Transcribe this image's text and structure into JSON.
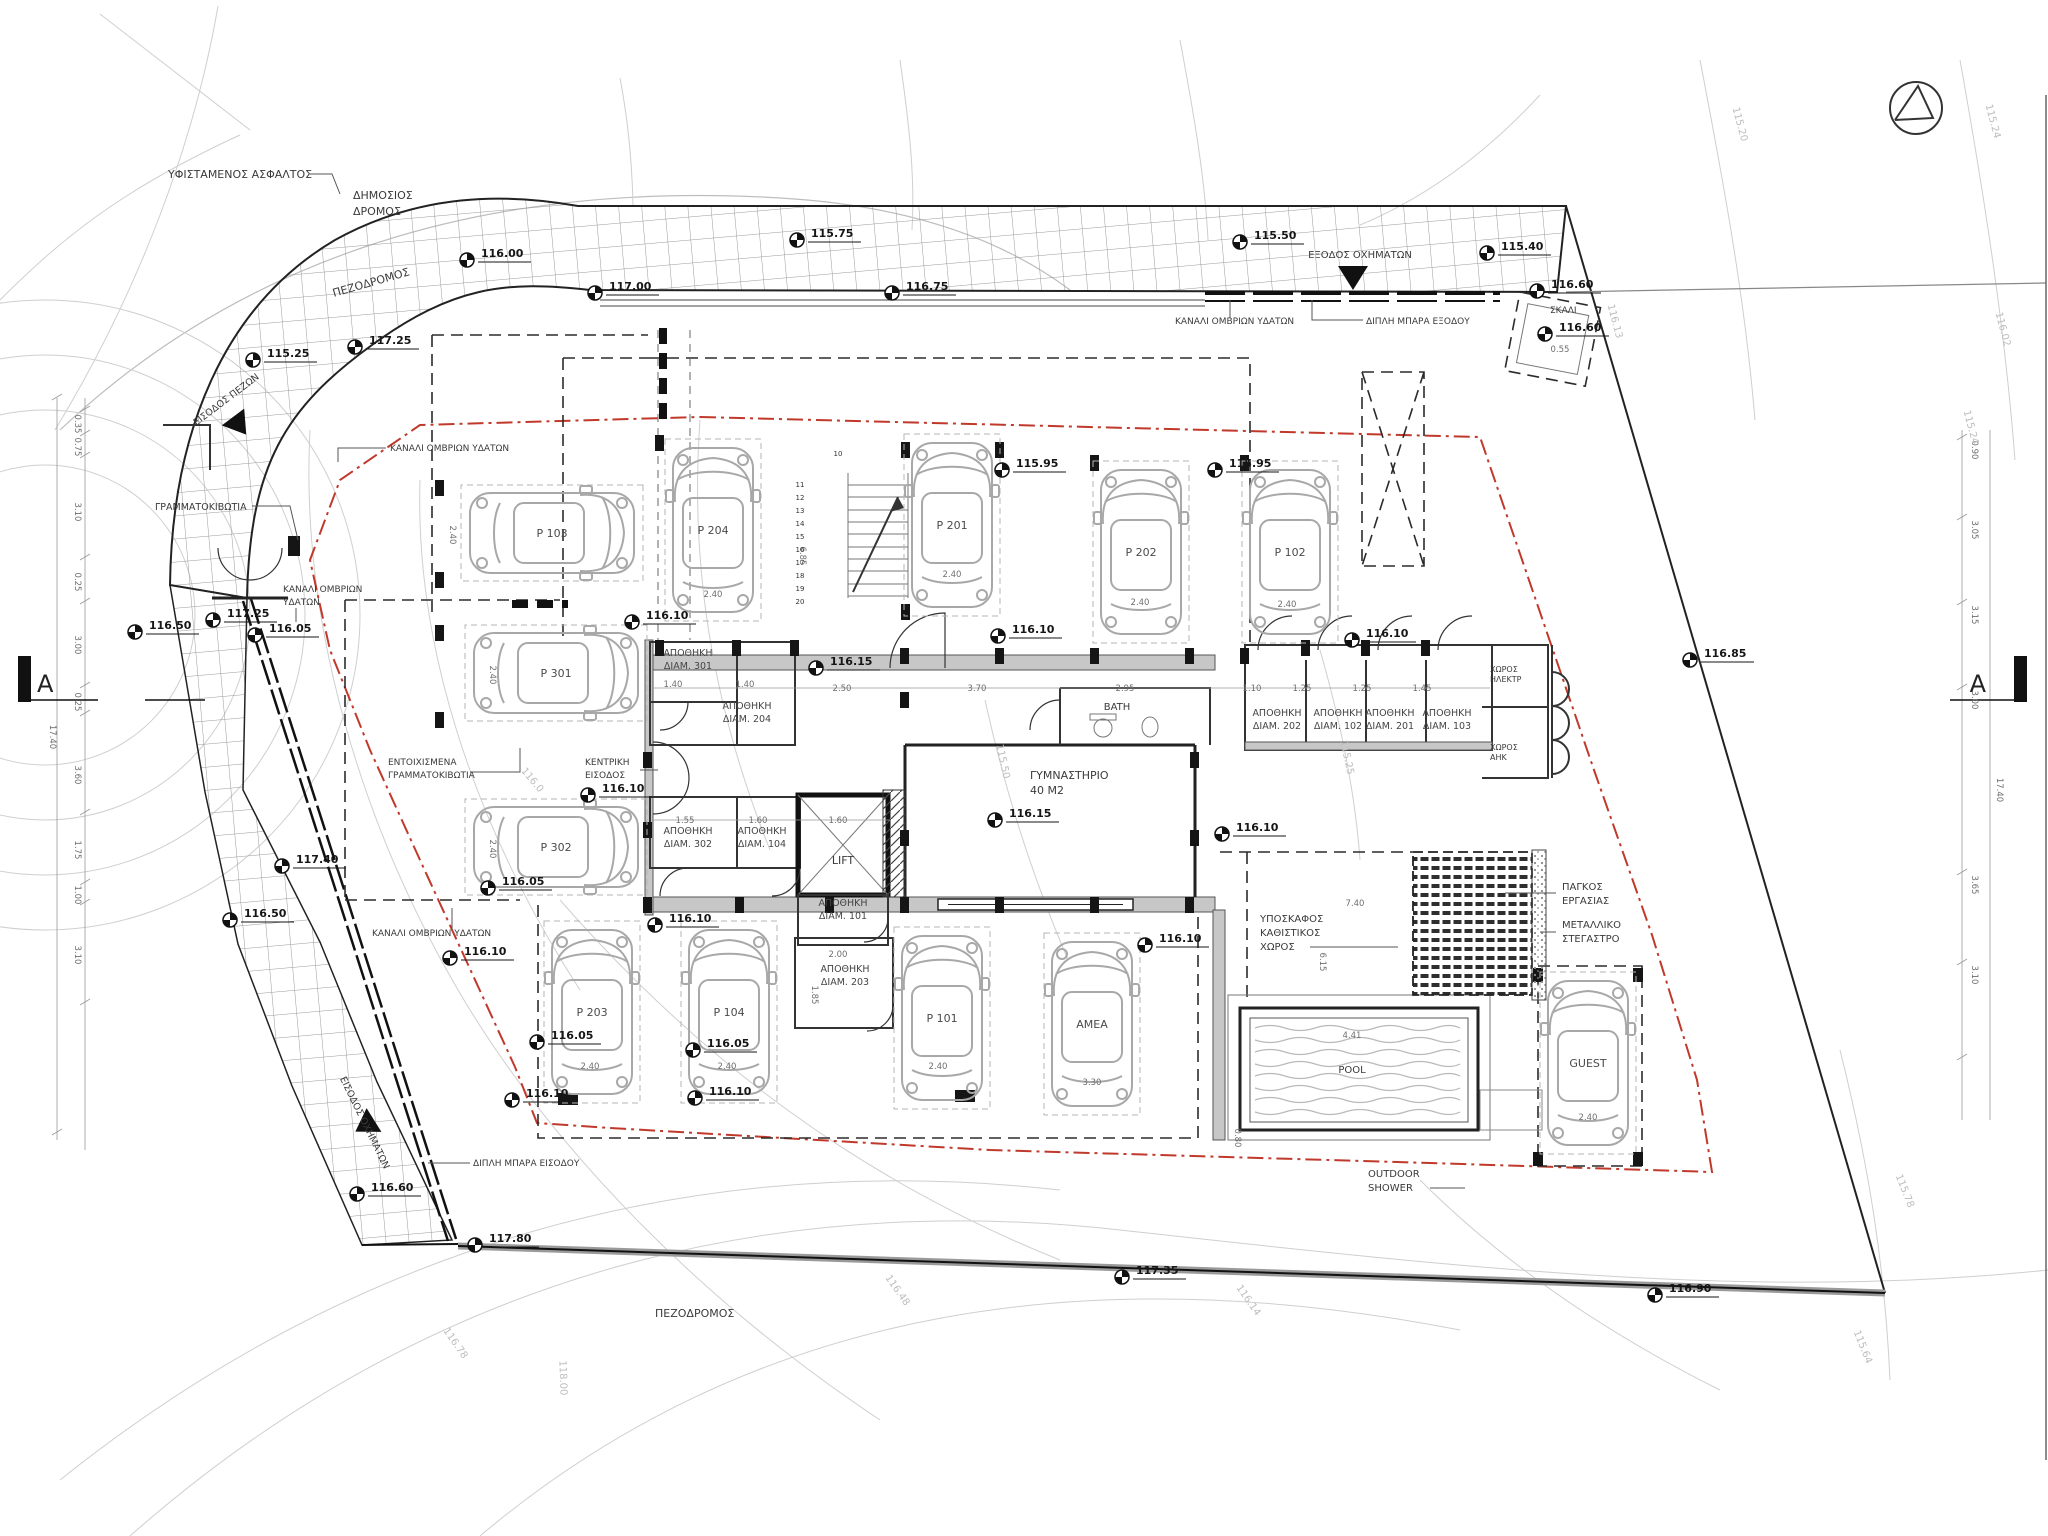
{
  "drawing": {
    "type": "architectural-site-plan",
    "language": "el"
  },
  "colors": {
    "boundary_red": "#c0392b",
    "hatch_gray": "#9a9a9a",
    "contour_gray": "#cfcfcf",
    "wall_dark": "#222222",
    "wall_fill": "#c7c7c7",
    "car_gray": "#a8a8a8"
  },
  "section_marker": {
    "letter": "A"
  },
  "annotations": [
    {
      "text": "ΥΦΙΣΤΑΜΕΝΟΣ ΑΣΦΑΛΤΟΣ",
      "x": 168,
      "y": 178,
      "size": 11
    },
    {
      "text": "ΔΗΜΟΣΙΟΣ",
      "x": 353,
      "y": 199,
      "size": 11
    },
    {
      "text": "ΔΡΟΜΟΣ",
      "x": 353,
      "y": 215,
      "size": 11
    },
    {
      "text": "ΠΕΖΟΔΡΟΜΟΣ",
      "x": 372,
      "y": 286,
      "size": 11,
      "rot": -16,
      "anchor": "middle"
    },
    {
      "text": "ΕΞΟΔΟΣ ΟΧΗΜΑΤΩΝ",
      "x": 1360,
      "y": 258,
      "size": 10,
      "anchor": "middle"
    },
    {
      "text": "ΚΑΝΑΛΙ ΟΜΒΡΙΩΝ ΥΔΑΤΩΝ",
      "x": 1175,
      "y": 324,
      "size": 9
    },
    {
      "text": "ΔΙΠΛΗ ΜΠΑΡΑ ΕΞΟΔΟΥ",
      "x": 1366,
      "y": 324,
      "size": 9
    },
    {
      "text": "ΣΚΑΛΙ",
      "x": 1550,
      "y": 313,
      "size": 9
    },
    {
      "text": "ΕΙΣΟΔΟΣ ΠΕΖΩΝ",
      "x": 228,
      "y": 402,
      "size": 9.5,
      "rot": -37,
      "anchor": "middle"
    },
    {
      "text": "ΓΡΑΜΜΑΤΟΚΙΒΩΤΙΑ",
      "x": 155,
      "y": 510,
      "size": 9.5
    },
    {
      "text": "ΚΑΝΑΛΙ ΟΜΒΡΙΩΝ",
      "x": 283,
      "y": 592,
      "size": 9
    },
    {
      "text": "ΥΔΑΤΩΝ",
      "x": 283,
      "y": 605,
      "size": 9
    },
    {
      "text": "ΚΑΝΑΛΙ ΟΜΒΡΙΩΝ ΥΔΑΤΩΝ",
      "x": 390,
      "y": 451,
      "size": 9
    },
    {
      "text": "ΕΝΤΟΙΧΙΣΜΕΝΑ",
      "x": 388,
      "y": 765,
      "size": 9
    },
    {
      "text": "ΓΡΑΜΜΑΤΟΚΙΒΩΤΙΑ",
      "x": 388,
      "y": 778,
      "size": 9
    },
    {
      "text": "ΚΕΝΤΡΙΚΗ",
      "x": 585,
      "y": 765,
      "size": 9
    },
    {
      "text": "ΕΙΣΟΔΟΣ",
      "x": 585,
      "y": 778,
      "size": 9
    },
    {
      "text": "ΚΑΝΑΛΙ ΟΜΒΡΙΩΝ ΥΔΑΤΩΝ",
      "x": 372,
      "y": 936,
      "size": 9
    },
    {
      "text": "ΕΙΣΟΔΟΣ ΟΧΗΜΑΤΩΝ",
      "x": 362,
      "y": 1124,
      "size": 9.5,
      "rot": 64,
      "anchor": "middle"
    },
    {
      "text": "ΔΙΠΛΗ ΜΠΑΡΑ ΕΙΣΟΔΟΥ",
      "x": 473,
      "y": 1166,
      "size": 9
    },
    {
      "text": "ΠΕΖΟΔΡΟΜΟΣ",
      "x": 655,
      "y": 1317,
      "size": 11
    },
    {
      "text": "ΓΥΜΝΑΣΤΗΡΙΟ",
      "x": 1030,
      "y": 779,
      "size": 11
    },
    {
      "text": "40 M2",
      "x": 1030,
      "y": 794,
      "size": 11
    },
    {
      "text": "BATH",
      "x": 1117,
      "y": 710,
      "size": 10,
      "anchor": "middle"
    },
    {
      "text": "LIFT",
      "x": 843,
      "y": 864,
      "size": 11,
      "anchor": "middle"
    },
    {
      "text": "ΥΠΟΣΚΑΦΟΣ",
      "x": 1260,
      "y": 922,
      "size": 10
    },
    {
      "text": "ΚΑΘΙΣΤΙΚΟΣ",
      "x": 1260,
      "y": 936,
      "size": 10
    },
    {
      "text": "ΧΩΡΟΣ",
      "x": 1260,
      "y": 950,
      "size": 10
    },
    {
      "text": "ΠΑΓΚΟΣ",
      "x": 1562,
      "y": 890,
      "size": 10
    },
    {
      "text": "ΕΡΓΑΣΙΑΣ",
      "x": 1562,
      "y": 904,
      "size": 10
    },
    {
      "text": "ΜΕΤΑΛΛΙΚΟ",
      "x": 1562,
      "y": 928,
      "size": 10
    },
    {
      "text": "ΣΤΕΓΑΣΤΡΟ",
      "x": 1562,
      "y": 942,
      "size": 10
    },
    {
      "text": "OUTDOOR",
      "x": 1368,
      "y": 1177,
      "size": 10
    },
    {
      "text": "SHOWER",
      "x": 1368,
      "y": 1191,
      "size": 10
    },
    {
      "text": "POOL",
      "x": 1352,
      "y": 1073,
      "size": 10,
      "anchor": "middle"
    },
    {
      "text": "ΧΩΡΟΣ",
      "x": 1490,
      "y": 672,
      "size": 8
    },
    {
      "text": "ΗΛΕΚΤΡ",
      "x": 1490,
      "y": 682,
      "size": 8
    },
    {
      "text": "ΧΩΡΟΣ",
      "x": 1490,
      "y": 750,
      "size": 8
    },
    {
      "text": "ΑΗΚ",
      "x": 1490,
      "y": 760,
      "size": 8
    }
  ],
  "elevation_markers": [
    {
      "value": "116.00",
      "x": 467,
      "y": 260
    },
    {
      "value": "115.75",
      "x": 797,
      "y": 240
    },
    {
      "value": "115.50",
      "x": 1240,
      "y": 242
    },
    {
      "value": "115.40",
      "x": 1487,
      "y": 253
    },
    {
      "value": "117.00",
      "x": 595,
      "y": 293
    },
    {
      "value": "116.75",
      "x": 892,
      "y": 293
    },
    {
      "value": "116.60",
      "x": 1537,
      "y": 291
    },
    {
      "value": "116.60",
      "x": 1545,
      "y": 334
    },
    {
      "value": "115.25",
      "x": 253,
      "y": 360
    },
    {
      "value": "117.25",
      "x": 355,
      "y": 347
    },
    {
      "value": "117.25",
      "x": 213,
      "y": 620
    },
    {
      "value": "116.50",
      "x": 135,
      "y": 632
    },
    {
      "value": "116.05",
      "x": 255,
      "y": 635
    },
    {
      "value": "117.40",
      "x": 282,
      "y": 866
    },
    {
      "value": "116.50",
      "x": 230,
      "y": 920
    },
    {
      "value": "116.60",
      "x": 357,
      "y": 1194
    },
    {
      "value": "117.80",
      "x": 475,
      "y": 1245
    },
    {
      "value": "117.35",
      "x": 1122,
      "y": 1277
    },
    {
      "value": "116.90",
      "x": 1655,
      "y": 1295
    },
    {
      "value": "116.85",
      "x": 1690,
      "y": 660
    },
    {
      "value": "116.10",
      "x": 632,
      "y": 622
    },
    {
      "value": "116.15",
      "x": 816,
      "y": 668
    },
    {
      "value": "116.10",
      "x": 998,
      "y": 636
    },
    {
      "value": "115.95",
      "x": 1002,
      "y": 470
    },
    {
      "value": "115.95",
      "x": 1215,
      "y": 470
    },
    {
      "value": "116.10",
      "x": 1352,
      "y": 640
    },
    {
      "value": "116.10",
      "x": 588,
      "y": 795
    },
    {
      "value": "116.15",
      "x": 995,
      "y": 820
    },
    {
      "value": "116.10",
      "x": 1222,
      "y": 834
    },
    {
      "value": "116.05",
      "x": 488,
      "y": 888
    },
    {
      "value": "116.10",
      "x": 655,
      "y": 925
    },
    {
      "value": "116.10",
      "x": 450,
      "y": 958
    },
    {
      "value": "116.10",
      "x": 1145,
      "y": 945
    },
    {
      "value": "116.05",
      "x": 537,
      "y": 1042
    },
    {
      "value": "116.05",
      "x": 693,
      "y": 1050
    },
    {
      "value": "116.10",
      "x": 512,
      "y": 1100
    },
    {
      "value": "116.10",
      "x": 695,
      "y": 1098
    }
  ],
  "parking_stalls": [
    {
      "label": "P 103",
      "x": 552,
      "y": 533,
      "rot": 90
    },
    {
      "label": "P 204",
      "x": 713,
      "y": 530,
      "rot": 0
    },
    {
      "label": "P 201",
      "x": 952,
      "y": 525,
      "rot": 0
    },
    {
      "label": "P 202",
      "x": 1141,
      "y": 552,
      "rot": 0
    },
    {
      "label": "P 102",
      "x": 1290,
      "y": 552,
      "rot": 0
    },
    {
      "label": "P 301",
      "x": 556,
      "y": 673,
      "rot": 90
    },
    {
      "label": "P 302",
      "x": 556,
      "y": 847,
      "rot": 90
    },
    {
      "label": "P 203",
      "x": 592,
      "y": 1012,
      "rot": 0
    },
    {
      "label": "P 104",
      "x": 729,
      "y": 1012,
      "rot": 0
    },
    {
      "label": "P 101",
      "x": 942,
      "y": 1018,
      "rot": 0
    },
    {
      "label": "AMEA",
      "x": 1092,
      "y": 1024,
      "rot": 0
    },
    {
      "label": "GUEST",
      "x": 1588,
      "y": 1063,
      "rot": 0
    }
  ],
  "storage_rooms": [
    {
      "line1": "ΑΠΟΘΗΚΗ",
      "line2": "ΔΙΑΜ. 301",
      "x": 688,
      "y": 656
    },
    {
      "line1": "ΑΠΟΘΗΚΗ",
      "line2": "ΔΙΑΜ. 204",
      "x": 747,
      "y": 709
    },
    {
      "line1": "ΑΠΟΘΗΚΗ",
      "line2": "ΔΙΑΜ. 302",
      "x": 688,
      "y": 834
    },
    {
      "line1": "ΑΠΟΘΗΚΗ",
      "line2": "ΔΙΑΜ. 104",
      "x": 762,
      "y": 834
    },
    {
      "line1": "ΑΠΟΘΗΚΗ",
      "line2": "ΔΙΑΜ. 101",
      "x": 843,
      "y": 906
    },
    {
      "line1": "ΑΠΟΘΗΚΗ",
      "line2": "ΔΙΑΜ. 203",
      "x": 845,
      "y": 972
    },
    {
      "line1": "ΑΠΟΘΗΚΗ",
      "line2": "ΔΙΑΜ. 202",
      "x": 1277,
      "y": 716
    },
    {
      "line1": "ΑΠΟΘΗΚΗ",
      "line2": "ΔΙΑΜ. 102",
      "x": 1338,
      "y": 716
    },
    {
      "line1": "ΑΠΟΘΗΚΗ",
      "line2": "ΔΙΑΜ. 201",
      "x": 1390,
      "y": 716
    },
    {
      "line1": "ΑΠΟΘΗΚΗ",
      "line2": "ΔΙΑΜ. 103",
      "x": 1447,
      "y": 716
    }
  ],
  "dimensions": [
    {
      "value": "2.50",
      "x": 842,
      "y": 691,
      "rot": 0
    },
    {
      "value": "3.70",
      "x": 977,
      "y": 691,
      "rot": 0
    },
    {
      "value": "2.95",
      "x": 1125,
      "y": 691,
      "rot": 0
    },
    {
      "value": "1.10",
      "x": 1252,
      "y": 691,
      "rot": 0
    },
    {
      "value": "1.25",
      "x": 1302,
      "y": 691,
      "rot": 0
    },
    {
      "value": "1.25",
      "x": 1362,
      "y": 691,
      "rot": 0
    },
    {
      "value": "1.45",
      "x": 1422,
      "y": 691,
      "rot": 0
    },
    {
      "value": "1.40",
      "x": 673,
      "y": 687,
      "rot": 0
    },
    {
      "value": "1.40",
      "x": 745,
      "y": 687,
      "rot": 0
    },
    {
      "value": "1.55",
      "x": 685,
      "y": 823,
      "rot": 0
    },
    {
      "value": "1.60",
      "x": 758,
      "y": 823,
      "rot": 0
    },
    {
      "value": "1.60",
      "x": 838,
      "y": 823,
      "rot": 0
    },
    {
      "value": "2.00",
      "x": 838,
      "y": 957,
      "rot": 0
    },
    {
      "value": "1.85",
      "x": 812,
      "y": 995,
      "rot": 90
    },
    {
      "value": "2.40",
      "x": 952,
      "y": 577,
      "rot": 0
    },
    {
      "value": "2.40",
      "x": 1140,
      "y": 605,
      "rot": 0
    },
    {
      "value": "2.40",
      "x": 1287,
      "y": 607,
      "rot": 0
    },
    {
      "value": "2.40",
      "x": 713,
      "y": 597,
      "rot": 0
    },
    {
      "value": "2.40",
      "x": 590,
      "y": 1069,
      "rot": 0
    },
    {
      "value": "2.40",
      "x": 727,
      "y": 1069,
      "rot": 0
    },
    {
      "value": "2.40",
      "x": 938,
      "y": 1069,
      "rot": 0
    },
    {
      "value": "3.30",
      "x": 1092,
      "y": 1085,
      "rot": 0
    },
    {
      "value": "2.40",
      "x": 1588,
      "y": 1120,
      "rot": 0
    },
    {
      "value": "2.40",
      "x": 450,
      "y": 535,
      "rot": 90
    },
    {
      "value": "2.40",
      "x": 490,
      "y": 675,
      "rot": 90
    },
    {
      "value": "2.40",
      "x": 490,
      "y": 849,
      "rot": 90
    },
    {
      "value": "7.40",
      "x": 1355,
      "y": 906,
      "rot": 0
    },
    {
      "value": "6.15",
      "x": 1320,
      "y": 962,
      "rot": 90
    },
    {
      "value": "0.80",
      "x": 1235,
      "y": 1138,
      "rot": 90
    },
    {
      "value": "4.41",
      "x": 1352,
      "y": 1038,
      "rot": 0
    },
    {
      "value": "0.55",
      "x": 1560,
      "y": 352,
      "rot": 0
    },
    {
      "value": "6.85",
      "x": 800,
      "y": 556,
      "rot": 90
    },
    {
      "value": "0.35",
      "x": 75,
      "y": 424,
      "rot": 90
    },
    {
      "value": "0.75",
      "x": 75,
      "y": 447,
      "rot": 90
    },
    {
      "value": "3.10",
      "x": 75,
      "y": 512,
      "rot": 90
    },
    {
      "value": "0.25",
      "x": 75,
      "y": 582,
      "rot": 90
    },
    {
      "value": "3.00",
      "x": 75,
      "y": 645,
      "rot": 90
    },
    {
      "value": "0.25",
      "x": 75,
      "y": 702,
      "rot": 90
    },
    {
      "value": "17.40",
      "x": 50,
      "y": 737,
      "rot": 90
    },
    {
      "value": "3.60",
      "x": 75,
      "y": 775,
      "rot": 90
    },
    {
      "value": "1.75",
      "x": 75,
      "y": 850,
      "rot": 90
    },
    {
      "value": "1.00",
      "x": 75,
      "y": 895,
      "rot": 90
    },
    {
      "value": "3.10",
      "x": 75,
      "y": 955,
      "rot": 90
    },
    {
      "value": "0.90",
      "x": 1972,
      "y": 450,
      "rot": 90
    },
    {
      "value": "3.05",
      "x": 1972,
      "y": 530,
      "rot": 90
    },
    {
      "value": "3.15",
      "x": 1972,
      "y": 615,
      "rot": 90
    },
    {
      "value": "3.00",
      "x": 1972,
      "y": 700,
      "rot": 90
    },
    {
      "value": "17.40",
      "x": 1997,
      "y": 790,
      "rot": 90
    },
    {
      "value": "3.65",
      "x": 1972,
      "y": 885,
      "rot": 90
    },
    {
      "value": "3.10",
      "x": 1972,
      "y": 975,
      "rot": 90
    }
  ],
  "contour_labels": [
    {
      "value": "115.20",
      "x": 1737,
      "y": 125,
      "rot": 75
    },
    {
      "value": "115.24",
      "x": 1990,
      "y": 122,
      "rot": 75
    },
    {
      "value": "116.02",
      "x": 2000,
      "y": 330,
      "rot": 75
    },
    {
      "value": "116.13",
      "x": 1612,
      "y": 322,
      "rot": 75
    },
    {
      "value": "115.24",
      "x": 1968,
      "y": 428,
      "rot": 75
    },
    {
      "value": "115.78",
      "x": 1902,
      "y": 1192,
      "rot": 68
    },
    {
      "value": "115.64",
      "x": 1860,
      "y": 1348,
      "rot": 68
    },
    {
      "value": "116.14",
      "x": 1246,
      "y": 1302,
      "rot": 55
    },
    {
      "value": "116.48",
      "x": 895,
      "y": 1292,
      "rot": 55
    },
    {
      "value": "116.78",
      "x": 453,
      "y": 1345,
      "rot": 55
    },
    {
      "value": "118.00",
      "x": 560,
      "y": 1378,
      "rot": 88
    },
    {
      "value": "115.50",
      "x": 1000,
      "y": 762,
      "rot": 78
    },
    {
      "value": "115.25",
      "x": 1344,
      "y": 758,
      "rot": 78
    },
    {
      "value": "116.0",
      "x": 530,
      "y": 782,
      "rot": 50
    }
  ],
  "stair_numbers": [
    "10",
    "11",
    "12",
    "13",
    "14",
    "15",
    "16",
    "17",
    "18",
    "19",
    "20"
  ]
}
